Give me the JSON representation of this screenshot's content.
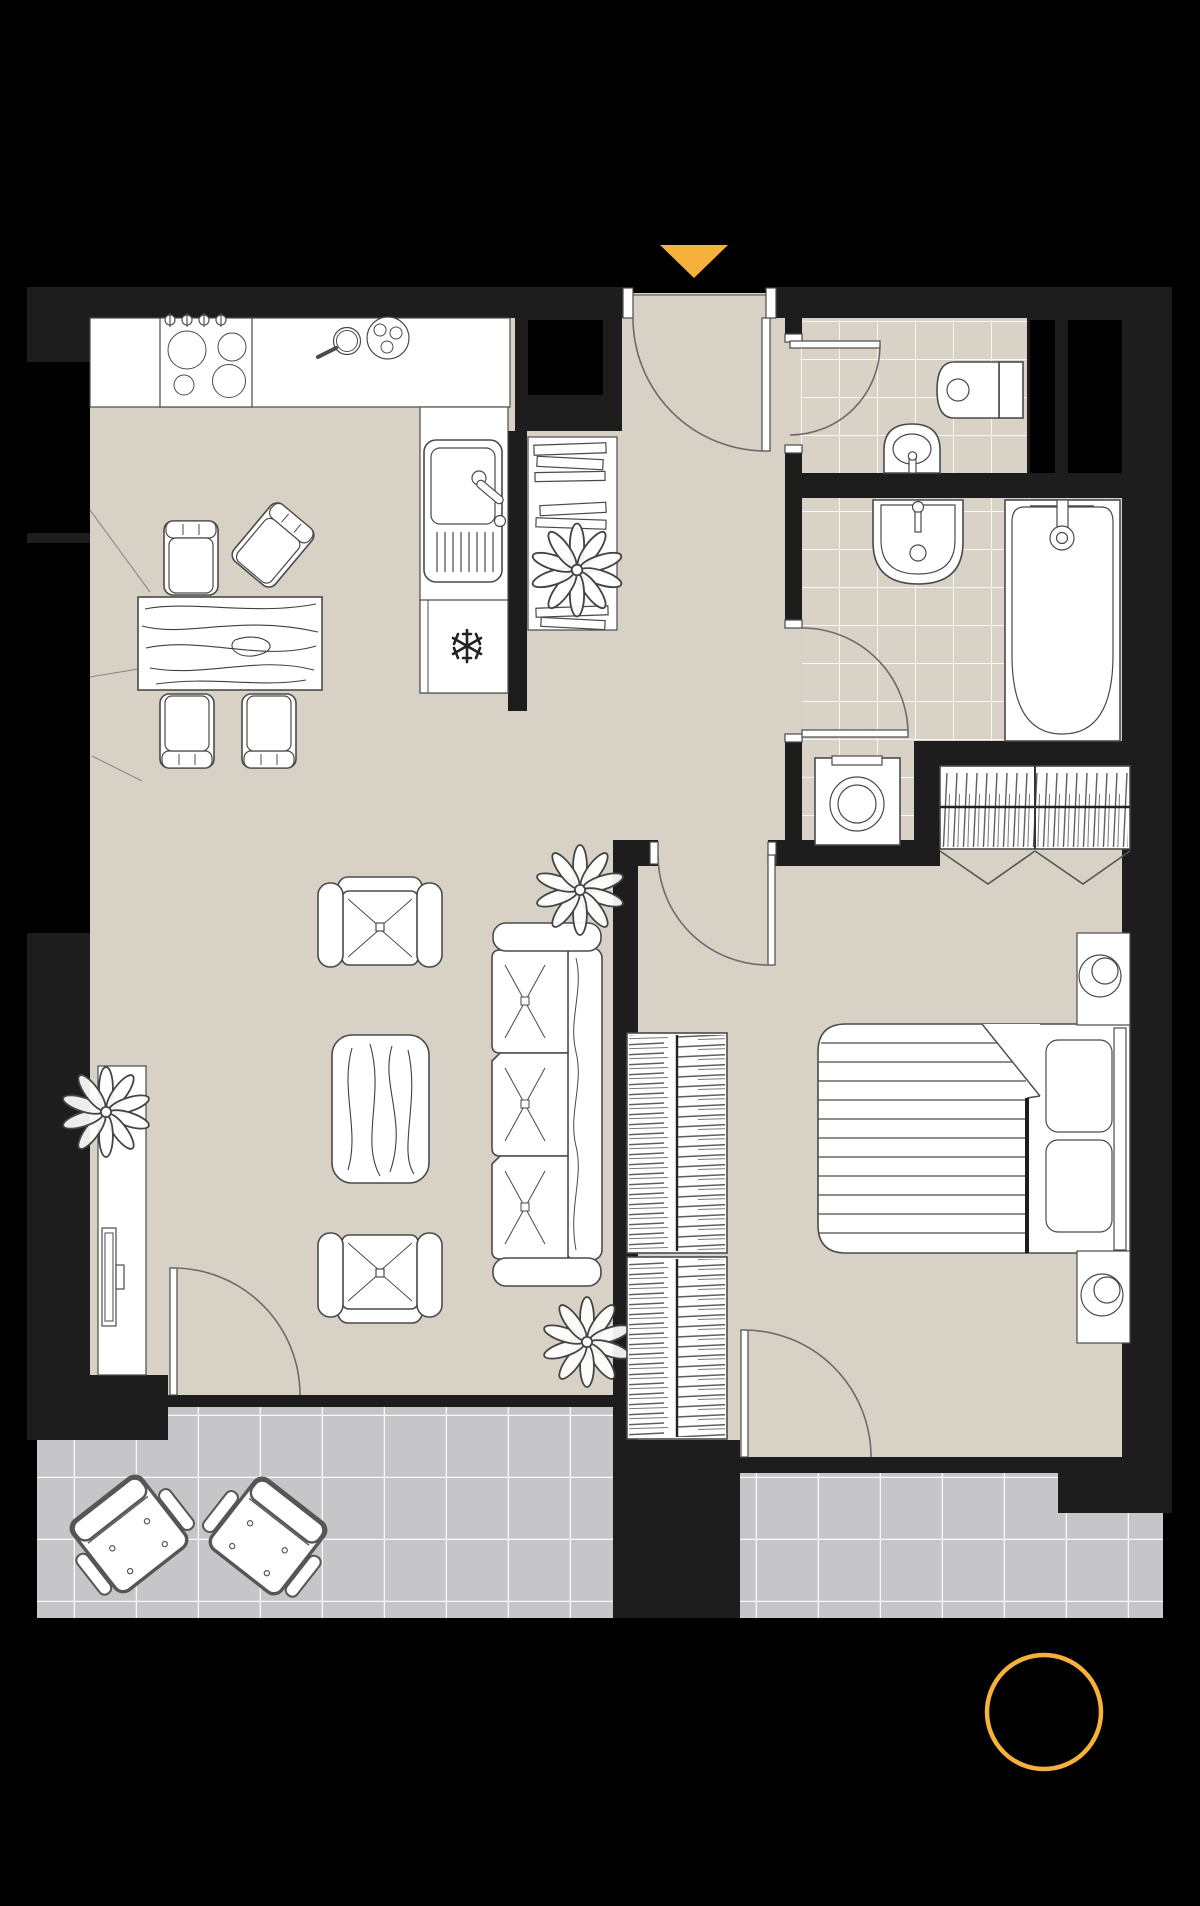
{
  "title": "apartment-floor-plan",
  "colors": {
    "bg": "#000000",
    "wall": "#1d1d1d",
    "floor": "#d8d1c6",
    "tile": "#d9d2c7",
    "balcony": "#c6c6c8",
    "white": "#ffffff",
    "line": "#4a4a4a",
    "accent": "#f6b03c"
  },
  "markers": {
    "entrance": {
      "shape": "triangle-down",
      "color": "#f6b03c"
    },
    "compass": {
      "shape": "circle-outline",
      "color": "#f6b03c"
    }
  },
  "rooms": [
    {
      "id": "kitchen-living-room",
      "floor": "wood-beige",
      "furniture": [
        "kitchen-counter",
        "stove-4-burners",
        "frying-pan",
        "serving-plate",
        "kitchen-sink",
        "freezer-box",
        "dining-table",
        "dining-chair-1",
        "dining-chair-2",
        "dining-chair-3",
        "dining-chair-4",
        "tv-stand",
        "tv",
        "plant",
        "armchair-1",
        "armchair-2",
        "coffee-table",
        "sofa-3-seat",
        "plant",
        "plant"
      ]
    },
    {
      "id": "hallway",
      "floor": "wood-beige",
      "furniture": [
        "bookshelf",
        "plant"
      ]
    },
    {
      "id": "wc",
      "floor": "ceramic-tile",
      "furniture": [
        "toilet",
        "small-sink"
      ]
    },
    {
      "id": "bathroom",
      "floor": "ceramic-tile",
      "furniture": [
        "sink",
        "bathtub",
        "washing-machine"
      ]
    },
    {
      "id": "bedroom",
      "floor": "wood-beige",
      "furniture": [
        "wardrobe-top",
        "wardrobe-left",
        "double-bed",
        "pillow",
        "pillow",
        "nightstand-lamp-1",
        "nightstand-lamp-2"
      ]
    },
    {
      "id": "balcony",
      "floor": "gray-tile",
      "furniture": [
        "outdoor-chair-1",
        "outdoor-chair-2"
      ]
    }
  ]
}
